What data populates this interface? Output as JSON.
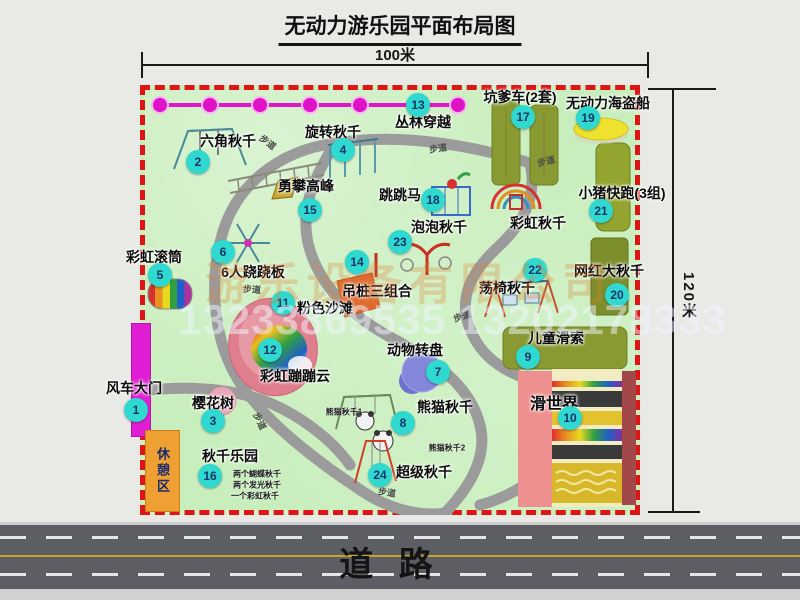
{
  "title": "无动力游乐园平面布局图",
  "dim_top": "100米",
  "dim_right": "120米",
  "road_label": "道  路",
  "rest_area_label": "休憩区",
  "watermark": {
    "company": "游乐设备有限公司",
    "phone": "13233869535 13202178333"
  },
  "colors": {
    "map_green": "#c9eebd",
    "border_red": "#dd1515",
    "badge_cyan": "#2fd9cf",
    "path_gray": "#9f9f9f",
    "zipline_magenta": "#e414ca",
    "gate_magenta": "#e01fd4",
    "rest_orange": "#efa033",
    "equipment_olive": "#8a9a33",
    "pirate_yellow": "#eee22e",
    "carousel_purple": "#8486da",
    "beach_pink": "#df7e8c",
    "road_gray": "#5d5d64",
    "road_yellow": "#c9a22a"
  },
  "features": [
    {
      "key": "jungle-crossing",
      "num": "13",
      "label": "丛林穿越",
      "lx": 283,
      "ly": 37,
      "bx": 278,
      "by": 20
    },
    {
      "key": "hexagon-swing",
      "num": "2",
      "label": "六角秋千",
      "lx": 88,
      "ly": 56,
      "bx": 58,
      "by": 77
    },
    {
      "key": "rotating-swing",
      "num": "4",
      "label": "旋转秋千",
      "lx": 193,
      "ly": 47,
      "bx": 203,
      "by": 65
    },
    {
      "key": "pit-car",
      "num": "17",
      "label": "坑爹车(2套)",
      "lx": 380,
      "ly": 12,
      "bx": 383,
      "by": 32
    },
    {
      "key": "pirate-ship",
      "num": "19",
      "label": "无动力海盗船",
      "lx": 468,
      "ly": 18,
      "bx": 448,
      "by": 33
    },
    {
      "key": "pig-run",
      "num": "21",
      "label": "小猪快跑(3组)",
      "lx": 482,
      "ly": 108,
      "bx": 461,
      "by": 126
    },
    {
      "key": "climb-peak",
      "num": "15",
      "label": "勇攀高峰",
      "lx": 166,
      "ly": 101,
      "bx": 170,
      "by": 125
    },
    {
      "key": "jump-horse",
      "num": "18",
      "label": "跳跳马",
      "lx": 260,
      "ly": 110,
      "bx": 293,
      "by": 115
    },
    {
      "key": "rainbow-swing",
      "num": null,
      "label": "彩虹秋千",
      "lx": 398,
      "ly": 138
    },
    {
      "key": "bubble-swing",
      "num": "23",
      "label": "泡泡秋千",
      "lx": 299,
      "ly": 142,
      "bx": 260,
      "by": 157
    },
    {
      "key": "rainbow-roller",
      "num": "5",
      "label": "彩虹滚筒",
      "lx": 14,
      "ly": 172,
      "bx": 20,
      "by": 190
    },
    {
      "key": "seesaw-6p",
      "num": "6",
      "label": "6人跷跷板",
      "lx": 113,
      "ly": 187,
      "bx": 83,
      "by": 167
    },
    {
      "key": "hanging-pile",
      "num": "14",
      "label": "吊桩三组合",
      "lx": 237,
      "ly": 206,
      "bx": 217,
      "by": 177
    },
    {
      "key": "chair-swing",
      "num": "22",
      "label": "荡椅秋千",
      "lx": 367,
      "ly": 203,
      "bx": 395,
      "by": 185
    },
    {
      "key": "big-swing",
      "num": "20",
      "label": "网红大秋千",
      "lx": 469,
      "ly": 186,
      "bx": 477,
      "by": 210
    },
    {
      "key": "pink-beach",
      "num": "11",
      "label": "粉色沙滩",
      "lx": 185,
      "ly": 223,
      "bx": 143,
      "by": 218
    },
    {
      "key": "rainbow-cloud",
      "num": "12",
      "label": "彩虹蹦蹦云",
      "lx": 155,
      "ly": 291,
      "bx": 130,
      "by": 265
    },
    {
      "key": "animal-carousel",
      "num": "7",
      "label": "动物转盘",
      "lx": 275,
      "ly": 265,
      "bx": 298,
      "by": 287
    },
    {
      "key": "kids-zipline",
      "num": "9",
      "label": "儿童滑索",
      "lx": 416,
      "ly": 253,
      "bx": 388,
      "by": 272
    },
    {
      "key": "slide-world",
      "num": "10",
      "label": "滑世界",
      "lx": 414,
      "ly": 317,
      "bx": 430,
      "by": 333,
      "fs": 16
    },
    {
      "key": "windmill-gate",
      "num": "1",
      "label": "风车大门",
      "lx": -6,
      "ly": 303,
      "bx": -4,
      "by": 325
    },
    {
      "key": "cherry-tree",
      "num": "3",
      "label": "樱花树",
      "lx": 73,
      "ly": 318,
      "bx": 73,
      "by": 336
    },
    {
      "key": "swing-park",
      "num": "16",
      "label": "秋千乐园",
      "lx": 90,
      "ly": 371,
      "bx": 70,
      "by": 391
    },
    {
      "key": "panda-swing",
      "num": "8",
      "label": "熊猫秋千",
      "lx": 305,
      "ly": 322,
      "bx": 263,
      "by": 338
    },
    {
      "key": "super-swing",
      "num": "24",
      "label": "超级秋千",
      "lx": 284,
      "ly": 387,
      "bx": 240,
      "by": 390
    }
  ],
  "sub_labels": [
    {
      "key": "panda-swing-1",
      "text": "熊猫秋千1",
      "x": 204,
      "y": 327
    },
    {
      "key": "panda-swing-2",
      "text": "熊猫秋千2",
      "x": 307,
      "y": 363
    },
    {
      "key": "swing-park-line1",
      "text": "两个蝴蝶秋千",
      "x": 117,
      "y": 389
    },
    {
      "key": "swing-park-line2",
      "text": "两个发光秋千",
      "x": 117,
      "y": 400
    },
    {
      "key": "swing-park-line3",
      "text": "一个彩虹秋千",
      "x": 115,
      "y": 411
    }
  ],
  "path_labels": [
    {
      "text": "步道",
      "x": 128,
      "y": 57,
      "rot": 38
    },
    {
      "text": "步道",
      "x": 298,
      "y": 63,
      "rot": -8
    },
    {
      "text": "步道",
      "x": 406,
      "y": 76,
      "rot": -14
    },
    {
      "text": "步道",
      "x": 112,
      "y": 204,
      "rot": 4
    },
    {
      "text": "步道",
      "x": 322,
      "y": 231,
      "rot": -18
    },
    {
      "text": "步道",
      "x": 120,
      "y": 336,
      "rot": 64
    },
    {
      "text": "步道",
      "x": 247,
      "y": 407,
      "rot": 8
    }
  ]
}
